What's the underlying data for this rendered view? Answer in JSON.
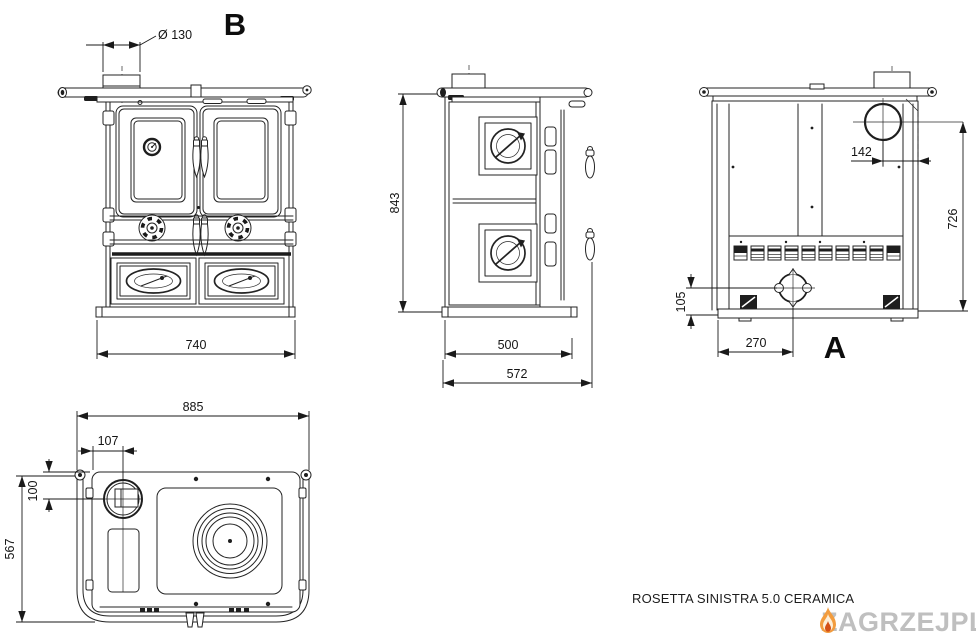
{
  "drawing": {
    "model_name": "ROSETTA SINISTRA 5.0 CERAMICA",
    "views": {
      "front": {
        "label": "B",
        "dim_flue_diameter": "Ø 130",
        "dim_width": "740"
      },
      "side": {
        "dim_height": "843",
        "dim_depth_body": "500",
        "dim_depth_total": "572"
      },
      "rear": {
        "label": "A",
        "dim_flue_offset": "142",
        "dim_flue_height": "726",
        "dim_inlet_height": "105",
        "dim_inlet_offset": "270"
      },
      "top": {
        "dim_width_total": "885",
        "dim_flue_x": "107",
        "dim_flue_y": "100",
        "dim_depth": "567"
      }
    }
  },
  "watermark": {
    "brand": "ZAGRZEJ",
    "suffix": "PL",
    "flame_icon": "flame-icon",
    "brand_color": "#bfbfbf",
    "flame_color": "#f29c3e"
  }
}
